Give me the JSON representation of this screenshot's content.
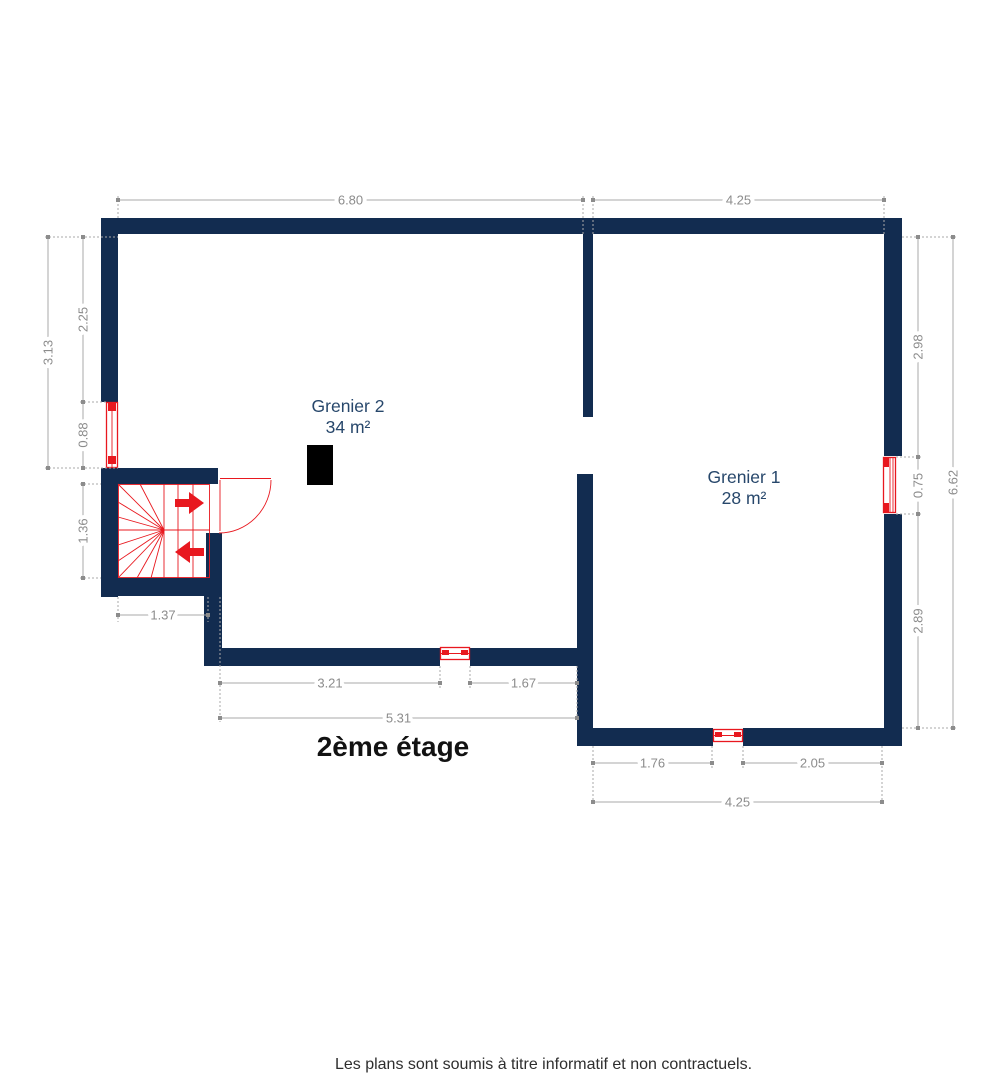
{
  "title": "2ème étage",
  "footer": "Les plans sont soumis à titre informatif et non contractuels.",
  "rooms": [
    {
      "name": "Grenier 2",
      "area": "34 m²"
    },
    {
      "name": "Grenier 1",
      "area": "28 m²"
    }
  ],
  "colors": {
    "wall": "#122c50",
    "red": "#e8181f",
    "dimline": "#a9a9a9",
    "dimtext": "#8c8c8c",
    "room": "#27476b",
    "title": "#121212",
    "footer": "#2e2e2e"
  },
  "dimensions": [
    {
      "label": "6.80",
      "x1": 118,
      "y1": 200,
      "x2": 583,
      "y2": 200,
      "rot": 0
    },
    {
      "label": "4.25",
      "x1": 593,
      "y1": 200,
      "x2": 884,
      "y2": 200,
      "rot": 0
    },
    {
      "label": "3.13",
      "x1": 48,
      "y1": 237,
      "x2": 48,
      "y2": 468,
      "rot": -90
    },
    {
      "label": "2.25",
      "x1": 83,
      "y1": 237,
      "x2": 83,
      "y2": 402,
      "rot": -90
    },
    {
      "label": "0.88",
      "x1": 83,
      "y1": 402,
      "x2": 83,
      "y2": 468,
      "rot": -90
    },
    {
      "label": "1.36",
      "x1": 83,
      "y1": 484,
      "x2": 83,
      "y2": 578,
      "rot": -90
    },
    {
      "label": "1.37",
      "x1": 118,
      "y1": 615,
      "x2": 208,
      "y2": 615,
      "rot": 0
    },
    {
      "label": "3.21",
      "x1": 220,
      "y1": 683,
      "x2": 440,
      "y2": 683,
      "rot": 0
    },
    {
      "label": "1.67",
      "x1": 470,
      "y1": 683,
      "x2": 577,
      "y2": 683,
      "rot": 0
    },
    {
      "label": "5.31",
      "x1": 220,
      "y1": 718,
      "x2": 577,
      "y2": 718,
      "rot": 0
    },
    {
      "label": "1.76",
      "x1": 593,
      "y1": 763,
      "x2": 712,
      "y2": 763,
      "rot": 0
    },
    {
      "label": "2.05",
      "x1": 743,
      "y1": 763,
      "x2": 882,
      "y2": 763,
      "rot": 0
    },
    {
      "label": "4.25",
      "x1": 593,
      "y1": 802,
      "x2": 882,
      "y2": 802,
      "rot": 0
    },
    {
      "label": "2.98",
      "x1": 918,
      "y1": 237,
      "x2": 918,
      "y2": 457,
      "rot": -90
    },
    {
      "label": "0.75",
      "x1": 918,
      "y1": 457,
      "x2": 918,
      "y2": 514,
      "rot": -90
    },
    {
      "label": "2.89",
      "x1": 918,
      "y1": 514,
      "x2": 918,
      "y2": 728,
      "rot": -90
    },
    {
      "label": "6.62",
      "x1": 953,
      "y1": 237,
      "x2": 953,
      "y2": 728,
      "rot": -90
    }
  ],
  "extensions": [
    {
      "x1": 45,
      "y1": 237,
      "x2": 118,
      "y2": 237
    },
    {
      "x1": 80,
      "y1": 402,
      "x2": 107,
      "y2": 402
    },
    {
      "x1": 45,
      "y1": 468,
      "x2": 118,
      "y2": 468
    },
    {
      "x1": 80,
      "y1": 484,
      "x2": 101,
      "y2": 484
    },
    {
      "x1": 80,
      "y1": 578,
      "x2": 101,
      "y2": 578
    },
    {
      "x1": 118,
      "y1": 196,
      "x2": 118,
      "y2": 220
    },
    {
      "x1": 583,
      "y1": 196,
      "x2": 583,
      "y2": 236
    },
    {
      "x1": 593,
      "y1": 196,
      "x2": 593,
      "y2": 236
    },
    {
      "x1": 884,
      "y1": 196,
      "x2": 884,
      "y2": 236
    },
    {
      "x1": 118,
      "y1": 597,
      "x2": 118,
      "y2": 622
    },
    {
      "x1": 208,
      "y1": 597,
      "x2": 208,
      "y2": 622
    },
    {
      "x1": 220,
      "y1": 597,
      "x2": 220,
      "y2": 722
    },
    {
      "x1": 440,
      "y1": 666,
      "x2": 440,
      "y2": 688
    },
    {
      "x1": 470,
      "y1": 666,
      "x2": 470,
      "y2": 688
    },
    {
      "x1": 577,
      "y1": 666,
      "x2": 577,
      "y2": 722
    },
    {
      "x1": 593,
      "y1": 746,
      "x2": 593,
      "y2": 806
    },
    {
      "x1": 712,
      "y1": 746,
      "x2": 712,
      "y2": 768
    },
    {
      "x1": 743,
      "y1": 746,
      "x2": 743,
      "y2": 768
    },
    {
      "x1": 882,
      "y1": 746,
      "x2": 882,
      "y2": 806
    },
    {
      "x1": 902,
      "y1": 237,
      "x2": 956,
      "y2": 237
    },
    {
      "x1": 896,
      "y1": 457,
      "x2": 921,
      "y2": 457
    },
    {
      "x1": 896,
      "y1": 514,
      "x2": 921,
      "y2": 514
    },
    {
      "x1": 902,
      "y1": 728,
      "x2": 956,
      "y2": 728
    }
  ]
}
